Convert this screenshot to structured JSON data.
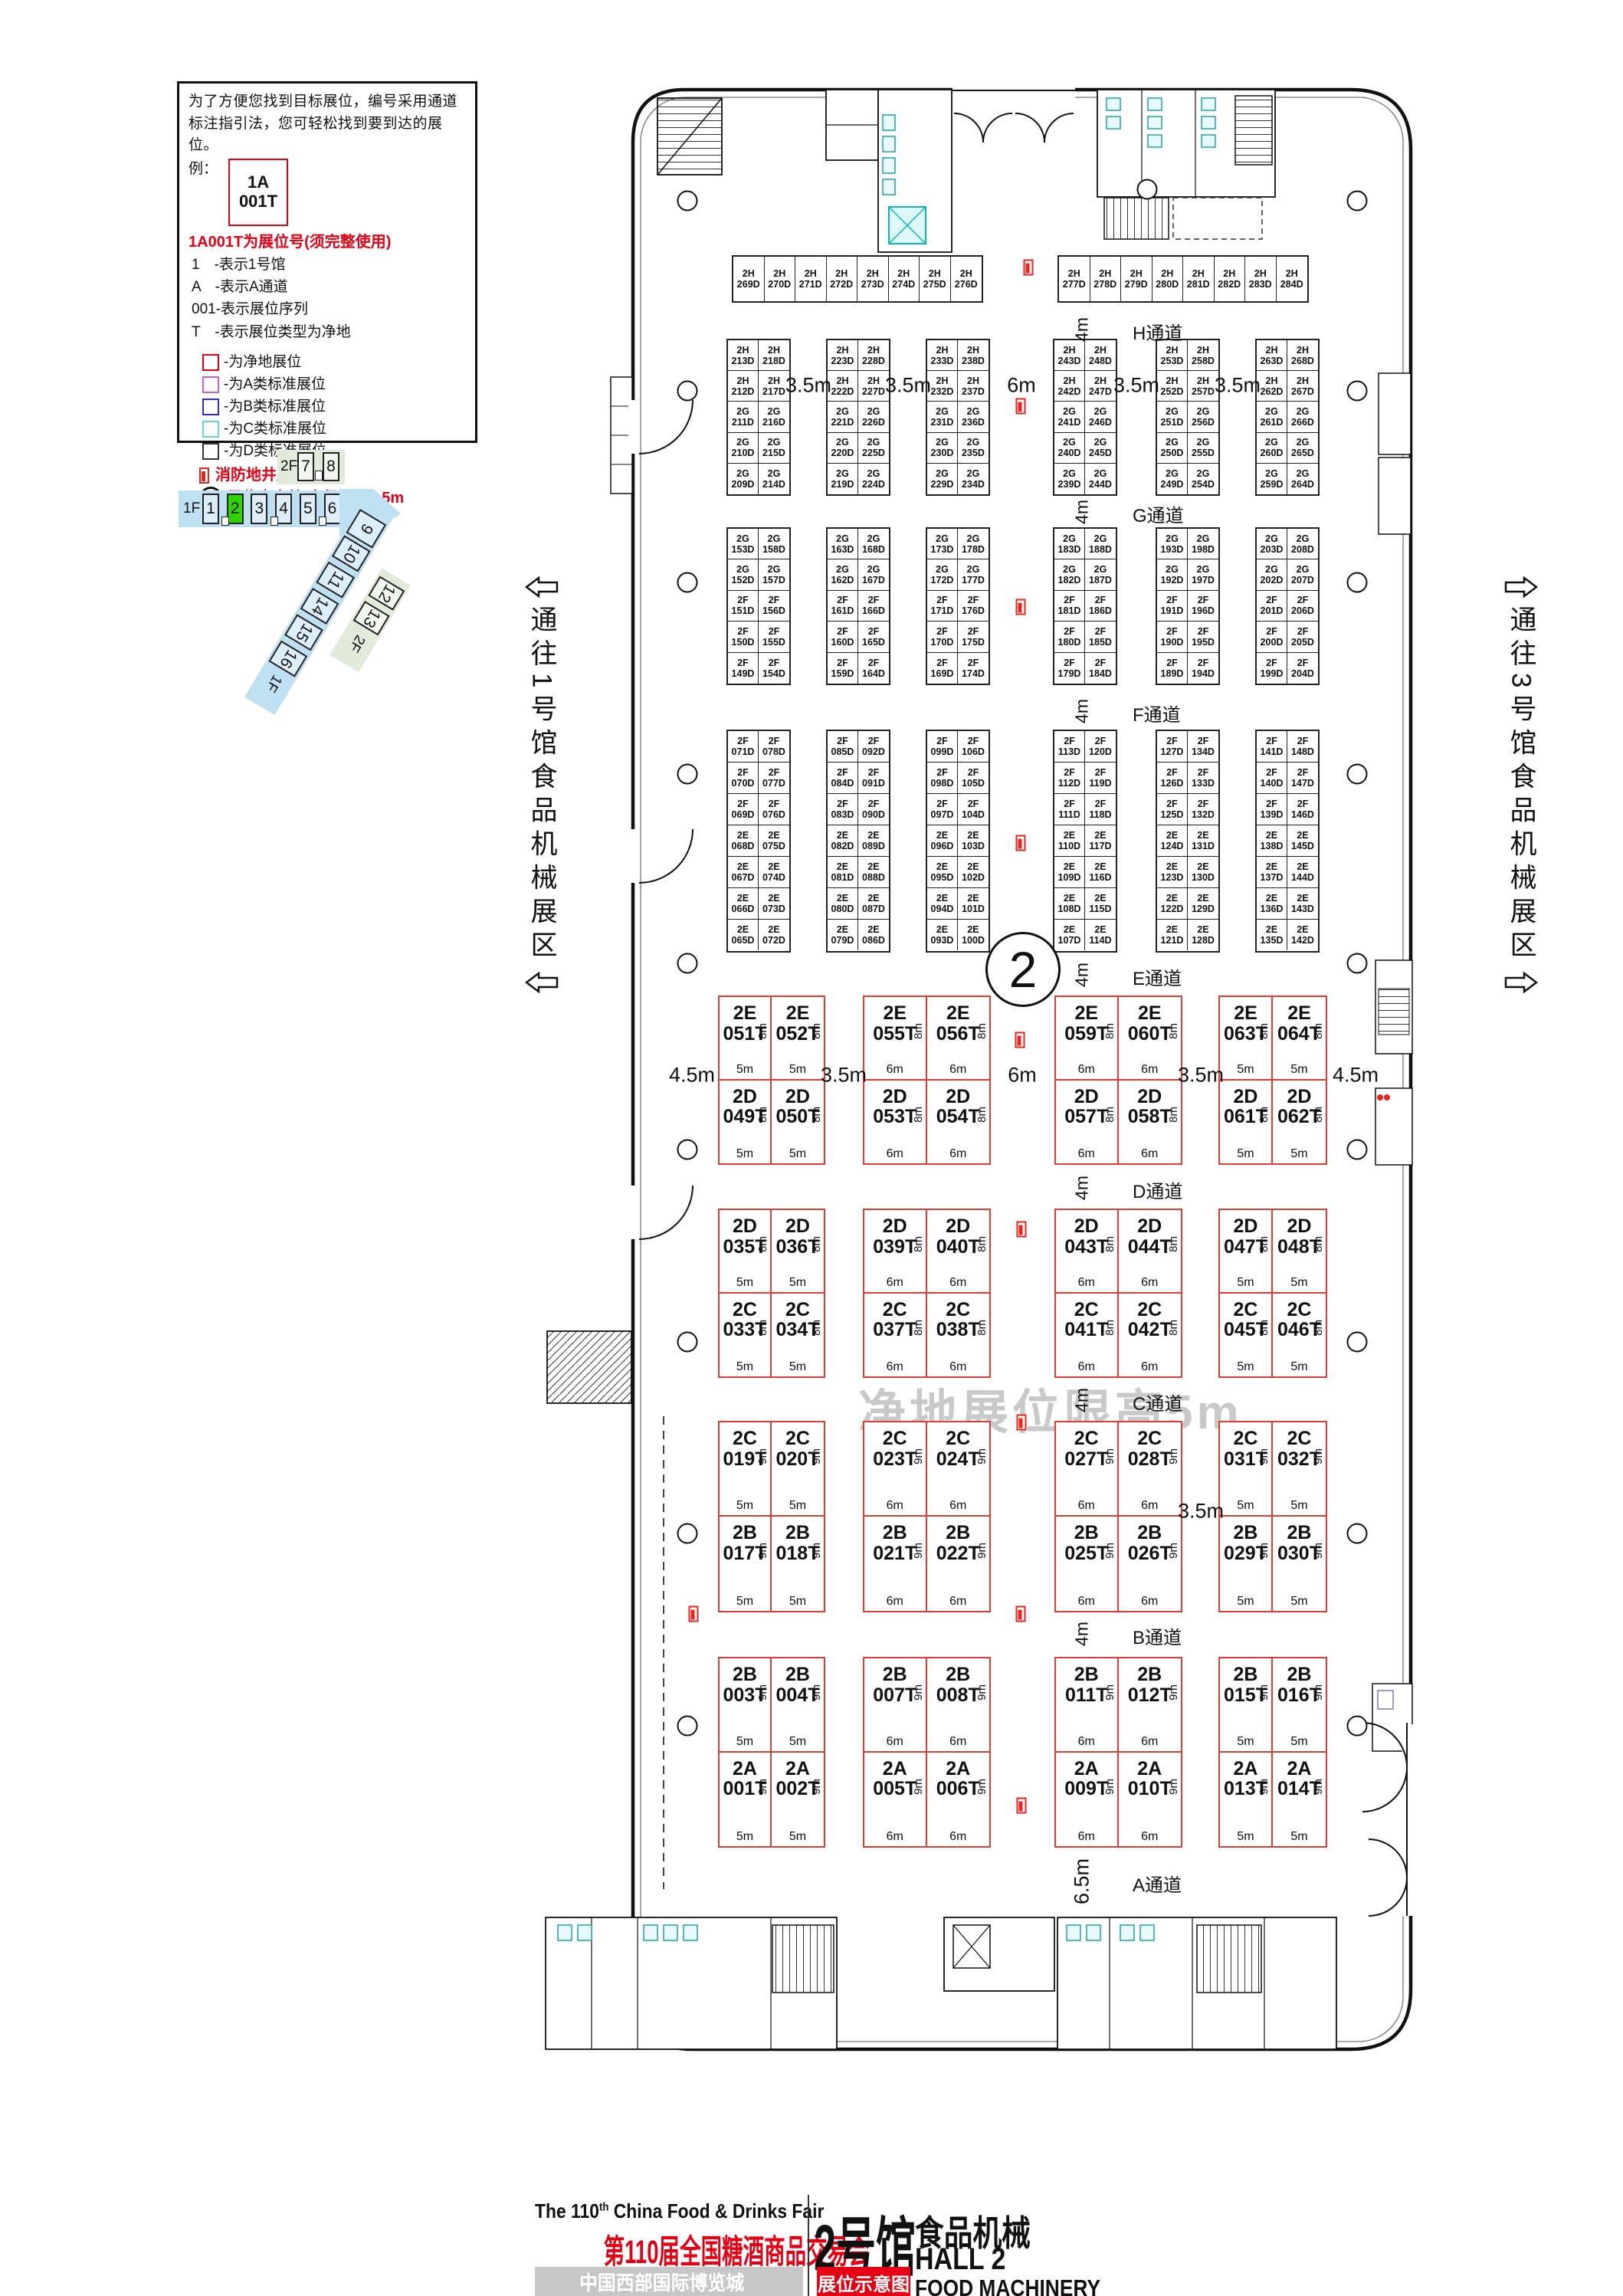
{
  "legend": {
    "intro": "为了方便您找到目标展位，编号采用通道标注指引法，您可轻松找到要到达的展位。",
    "example_label": "例：",
    "example_booth_line1": "1A",
    "example_booth_line2": "001T",
    "red_title": "1A001T为展位号(须完整使用)",
    "lines": [
      "1　-表示1号馆",
      "A　-表示A通道",
      "001-表示展位序列",
      "T　-表示展位类型为净地"
    ],
    "swatches": [
      {
        "label": "-为净地展位",
        "color": "#e60012"
      },
      {
        "label": "-为A类标准展位",
        "color": "#c95fd0"
      },
      {
        "label": "-为B类标准展位",
        "color": "#2d2dd0"
      },
      {
        "label": "-为C类标准展位",
        "color": "#5fd8d8"
      },
      {
        "label": "-为D类标准展位",
        "color": "#333333"
      }
    ],
    "fire_note": "消防地井严禁遮挡",
    "column_note": "展位内立柱 直径均为1.5m"
  },
  "minimap": {
    "floor2_label": "2F",
    "floor1_label": "1F",
    "halls_top": [
      "7",
      "8"
    ],
    "halls_main": [
      "1",
      "2",
      "3",
      "4",
      "5",
      "6"
    ],
    "highlight_hall": "2",
    "halls_diag": [
      "9",
      "10",
      "11",
      "14",
      "15",
      "16"
    ],
    "diag_floor_label": "1F",
    "halls_diag2": [
      "12",
      "13"
    ],
    "diag2_floor_label": "2F",
    "band_blue": "#bfe0f3",
    "band_green": "#e2ead9",
    "highlight_green": "#2fd500"
  },
  "side_labels": {
    "left": "通往1号馆食品机械展区",
    "right": "通往3号馆食品机械展区"
  },
  "hall_circle": "2",
  "watermark": "净地展位限高5m",
  "plan": {
    "aisles": [
      {
        "name": "H通道",
        "dim": "4m"
      },
      {
        "name": "G通道",
        "dim": "4m"
      },
      {
        "name": "F通道",
        "dim": "4m"
      },
      {
        "name": "E通道",
        "dim": "4m"
      },
      {
        "name": "D通道",
        "dim": "4m"
      },
      {
        "name": "C通道",
        "dim": "4m"
      },
      {
        "name": "B通道",
        "dim": "4m"
      },
      {
        "name": "A通道",
        "dim": "6.5m"
      }
    ],
    "top_row": {
      "blocks": [
        [
          "2H 269D",
          "2H 270D",
          "2H 271D",
          "2H 272D",
          "2H 273D",
          "2H 274D",
          "2H 275D",
          "2H 276D"
        ],
        [
          "2H 277D",
          "2H 278D",
          "2H 279D",
          "2H 280D",
          "2H 281D",
          "2H 282D",
          "2H 283D",
          "2H 284D"
        ]
      ]
    },
    "grids": [
      {
        "dims": [
          "3.5m",
          "3.5m",
          "6m",
          "3.5m",
          "3.5m"
        ],
        "groups": [
          [
            [
              "2H 213D",
              "2H 218D"
            ],
            [
              "2H 212D",
              "2H 217D"
            ],
            [
              "2G 211D",
              "2G 216D"
            ],
            [
              "2G 210D",
              "2G 215D"
            ],
            [
              "2G 209D",
              "2G 214D"
            ]
          ],
          [
            [
              "2H 223D",
              "2H 228D"
            ],
            [
              "2H 222D",
              "2H 227D"
            ],
            [
              "2G 221D",
              "2G 226D"
            ],
            [
              "2G 220D",
              "2G 225D"
            ],
            [
              "2G 219D",
              "2G 224D"
            ]
          ],
          [
            [
              "2H 233D",
              "2H 238D"
            ],
            [
              "2H 232D",
              "2H 237D"
            ],
            [
              "2G 231D",
              "2G 236D"
            ],
            [
              "2G 230D",
              "2G 235D"
            ],
            [
              "2G 229D",
              "2G 234D"
            ]
          ],
          [
            [
              "2H 243D",
              "2H 248D"
            ],
            [
              "2H 242D",
              "2H 247D"
            ],
            [
              "2G 241D",
              "2G 246D"
            ],
            [
              "2G 240D",
              "2G 245D"
            ],
            [
              "2G 239D",
              "2G 244D"
            ]
          ],
          [
            [
              "2H 253D",
              "2H 258D"
            ],
            [
              "2H 252D",
              "2H 257D"
            ],
            [
              "2G 251D",
              "2G 256D"
            ],
            [
              "2G 250D",
              "2G 255D"
            ],
            [
              "2G 249D",
              "2G 254D"
            ]
          ],
          [
            [
              "2H 263D",
              "2H 268D"
            ],
            [
              "2H 262D",
              "2H 267D"
            ],
            [
              "2G 261D",
              "2G 266D"
            ],
            [
              "2G 260D",
              "2G 265D"
            ],
            [
              "2G 259D",
              "2G 264D"
            ]
          ]
        ]
      },
      {
        "dims": [],
        "groups": [
          [
            [
              "2G 153D",
              "2G 158D"
            ],
            [
              "2G 152D",
              "2G 157D"
            ],
            [
              "2F 151D",
              "2F 156D"
            ],
            [
              "2F 150D",
              "2F 155D"
            ],
            [
              "2F 149D",
              "2F 154D"
            ]
          ],
          [
            [
              "2G 163D",
              "2G 168D"
            ],
            [
              "2G 162D",
              "2G 167D"
            ],
            [
              "2F 161D",
              "2F 166D"
            ],
            [
              "2F 160D",
              "2F 165D"
            ],
            [
              "2F 159D",
              "2F 164D"
            ]
          ],
          [
            [
              "2G 173D",
              "2G 178D"
            ],
            [
              "2G 172D",
              "2G 177D"
            ],
            [
              "2F 171D",
              "2F 176D"
            ],
            [
              "2F 170D",
              "2F 175D"
            ],
            [
              "2F 169D",
              "2F 174D"
            ]
          ],
          [
            [
              "2G 183D",
              "2G 188D"
            ],
            [
              "2G 182D",
              "2G 187D"
            ],
            [
              "2F 181D",
              "2F 186D"
            ],
            [
              "2F 180D",
              "2F 185D"
            ],
            [
              "2F 179D",
              "2F 184D"
            ]
          ],
          [
            [
              "2G 193D",
              "2G 198D"
            ],
            [
              "2G 192D",
              "2G 197D"
            ],
            [
              "2F 191D",
              "2F 196D"
            ],
            [
              "2F 190D",
              "2F 195D"
            ],
            [
              "2F 189D",
              "2F 194D"
            ]
          ],
          [
            [
              "2G 203D",
              "2G 208D"
            ],
            [
              "2G 202D",
              "2G 207D"
            ],
            [
              "2F 201D",
              "2F 206D"
            ],
            [
              "2F 200D",
              "2F 205D"
            ],
            [
              "2F 199D",
              "2F 204D"
            ]
          ]
        ]
      },
      {
        "dims": [],
        "groups": [
          [
            [
              "2F 071D",
              "2F 078D"
            ],
            [
              "2F 070D",
              "2F 077D"
            ],
            [
              "2F 069D",
              "2F 076D"
            ],
            [
              "2E 068D",
              "2E 075D"
            ],
            [
              "2E 067D",
              "2E 074D"
            ],
            [
              "2E 066D",
              "2E 073D"
            ],
            [
              "2E 065D",
              "2E 072D"
            ]
          ],
          [
            [
              "2F 085D",
              "2F 092D"
            ],
            [
              "2F 084D",
              "2F 091D"
            ],
            [
              "2F 083D",
              "2F 090D"
            ],
            [
              "2E 082D",
              "2E 089D"
            ],
            [
              "2E 081D",
              "2E 088D"
            ],
            [
              "2E 080D",
              "2E 087D"
            ],
            [
              "2E 079D",
              "2E 086D"
            ]
          ],
          [
            [
              "2F 099D",
              "2F 106D"
            ],
            [
              "2F 098D",
              "2F 105D"
            ],
            [
              "2F 097D",
              "2F 104D"
            ],
            [
              "2E 096D",
              "2E 103D"
            ],
            [
              "2E 095D",
              "2E 102D"
            ],
            [
              "2E 094D",
              "2E 101D"
            ],
            [
              "2E 093D",
              "2E 100D"
            ]
          ],
          [
            [
              "2F 113D",
              "2F 120D"
            ],
            [
              "2F 112D",
              "2F 119D"
            ],
            [
              "2F 111D",
              "2F 118D"
            ],
            [
              "2E 110D",
              "2E 117D"
            ],
            [
              "2E 109D",
              "2E 116D"
            ],
            [
              "2E 108D",
              "2E 115D"
            ],
            [
              "2E 107D",
              "2E 114D"
            ]
          ],
          [
            [
              "2F 127D",
              "2F 134D"
            ],
            [
              "2F 126D",
              "2F 133D"
            ],
            [
              "2F 125D",
              "2F 132D"
            ],
            [
              "2E 124D",
              "2E 131D"
            ],
            [
              "2E 123D",
              "2E 130D"
            ],
            [
              "2E 122D",
              "2E 129D"
            ],
            [
              "2E 121D",
              "2E 128D"
            ]
          ],
          [
            [
              "2F 141D",
              "2F 148D"
            ],
            [
              "2F 140D",
              "2F 147D"
            ],
            [
              "2F 139D",
              "2F 146D"
            ],
            [
              "2E 138D",
              "2E 145D"
            ],
            [
              "2E 137D",
              "2E 144D"
            ],
            [
              "2E 136D",
              "2E 143D"
            ],
            [
              "2E 135D",
              "2E 142D"
            ]
          ]
        ]
      }
    ],
    "big_widths": [
      [
        "5m",
        "5m"
      ],
      [
        "6m",
        "6m"
      ],
      [
        "6m",
        "6m"
      ],
      [
        "5m",
        "5m"
      ]
    ],
    "bigs": [
      {
        "side": "8m",
        "dims": [
          "4.5m",
          "3.5m",
          "6m",
          "3.5m",
          "4.5m"
        ],
        "top": [
          "2E 051T",
          "2E 052T",
          "2E 055T",
          "2E 056T",
          "2E 059T",
          "2E 060T",
          "2E 063T",
          "2E 064T"
        ],
        "bottom": [
          "2D 049T",
          "2D 050T",
          "2D 053T",
          "2D 054T",
          "2D 057T",
          "2D 058T",
          "2D 061T",
          "2D 062T"
        ]
      },
      {
        "side": "8m",
        "dims": [
          null,
          null,
          null,
          null,
          null
        ],
        "top": [
          "2D 035T",
          "2D 036T",
          "2D 039T",
          "2D 040T",
          "2D 043T",
          "2D 044T",
          "2D 047T",
          "2D 048T"
        ],
        "bottom": [
          "2C 033T",
          "2C 034T",
          "2C 037T",
          "2C 038T",
          "2C 041T",
          "2C 042T",
          "2C 045T",
          "2C 046T"
        ]
      },
      {
        "side": "9m",
        "dims": [
          null,
          null,
          null,
          "3.5m",
          null
        ],
        "top": [
          "2C 019T",
          "2C 020T",
          "2C 023T",
          "2C 024T",
          "2C 027T",
          "2C 028T",
          "2C 031T",
          "2C 032T"
        ],
        "bottom": [
          "2B 017T",
          "2B 018T",
          "2B 021T",
          "2B 022T",
          "2B 025T",
          "2B 026T",
          "2B 029T",
          "2B 030T"
        ]
      },
      {
        "side": "9m",
        "dims": [
          null,
          null,
          null,
          null,
          null
        ],
        "top": [
          "2B 003T",
          "2B 004T",
          "2B 007T",
          "2B 008T",
          "2B 011T",
          "2B 012T",
          "2B 015T",
          "2B 016T"
        ],
        "bottom": [
          "2A 001T",
          "2A 002T",
          "2A 005T",
          "2A 006T",
          "2A 009T",
          "2A 010T",
          "2A 013T",
          "2A 014T"
        ]
      }
    ]
  },
  "footer": {
    "en_pre": "The 110",
    "en_sup": "th",
    "en_post": " China Food & Drinks Fair",
    "cn_title": "第110届全国糖酒商品交易会",
    "venue": "中国西部国际博览城",
    "hall_cn": "2号馆",
    "hall_sub": "食品机械",
    "hall_en": "HALL 2",
    "hall_en2": "FOOD MACHINERY",
    "badge": "展位示意图"
  }
}
